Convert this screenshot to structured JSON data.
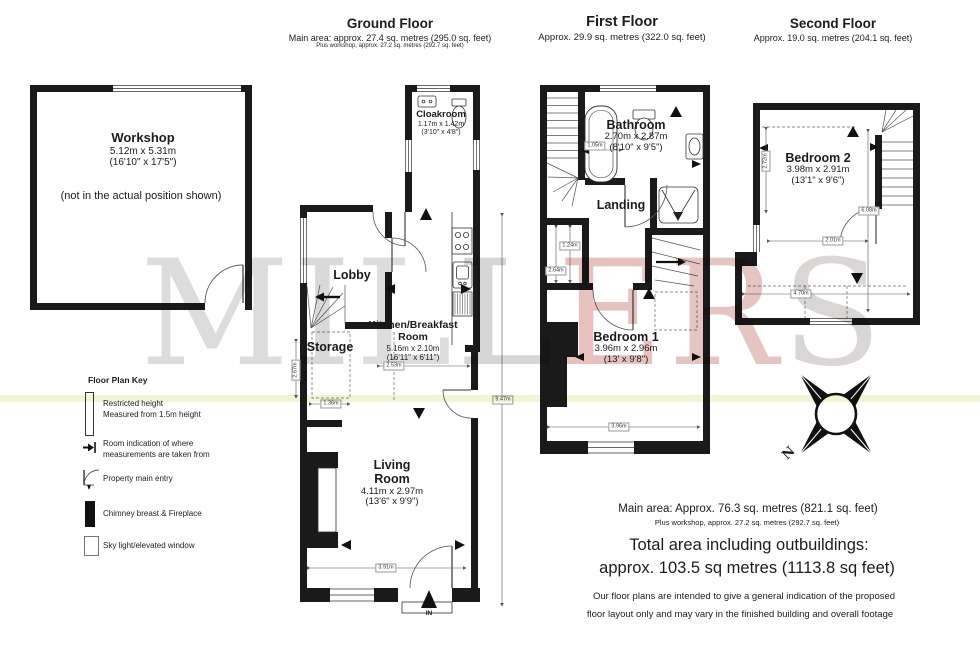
{
  "watermark": {
    "letters": [
      "M",
      "I",
      "L",
      "L",
      "E",
      "R",
      "S"
    ]
  },
  "floors": {
    "ground": {
      "title": "Ground Floor",
      "area_line1": "Main area: approx. 27.4 sq. metres (295.0 sq. feet)",
      "area_line2": "Plus workshop, approx. 27.2 sq. metres (292.7 sq. feet)",
      "workshop": {
        "name": "Workshop",
        "size_m": "5.12m x 5.31m",
        "size_ft": "(16'10\" x 17'5\")",
        "note": "(not in the actual position shown)"
      },
      "cloakroom": {
        "name": "Cloakroom",
        "size_m": "1.17m x 1.42m",
        "size_ft": "(3'10\" x 4'8\")"
      },
      "lobby": {
        "name": "Lobby"
      },
      "storage": {
        "name": "Storage"
      },
      "kitchen": {
        "name": "Kitchen/Breakfast Room",
        "size_m": "5.16m x 2.10m",
        "size_ft": "(16'11\" x 6'11\")"
      },
      "living": {
        "name": "Living Room",
        "size_m": "4.11m x 2.97m",
        "size_ft": "(13'6\" x 9'9\")"
      },
      "entry_label": "IN",
      "dims": {
        "left_height": "2.67m",
        "storage_width": "1.36m",
        "kitchen_width": "2.53m",
        "living_width": "3.91m",
        "total_height": "9.47m"
      }
    },
    "first": {
      "title": "First Floor",
      "area_line1": "Approx. 29.9 sq. metres (322.0 sq. feet)",
      "bathroom": {
        "name": "Bathroom",
        "size_m": "2.70m x 2.87m",
        "size_ft": "(8'10\" x 9'5\")"
      },
      "landing": {
        "name": "Landing"
      },
      "bedroom1": {
        "name": "Bedroom 1",
        "size_m": "3.96m x 2.96m",
        "size_ft": "(13' x 9'8\")"
      },
      "dims": {
        "bath_width": "1.05m",
        "closet_a": "1.24m",
        "closet_b": "2.64m",
        "bedroom_width": "3.96m"
      }
    },
    "second": {
      "title": "Second Floor",
      "area_line1": "Approx. 19.0 sq. metres (204.1 sq. feet)",
      "bedroom2": {
        "name": "Bedroom 2",
        "size_m": "3.98m x 2.91m",
        "size_ft": "(13'1\" x 9'6\")"
      },
      "dims": {
        "left_height": "2.72m",
        "mid_width": "2.01m",
        "bottom_width": "4.70m",
        "right_height": "6.08m"
      }
    }
  },
  "key": {
    "title": "Floor Plan Key",
    "items": [
      {
        "icon": "restricted-height-icon",
        "label": "Restricted height\nMeasured from 1.5m height"
      },
      {
        "icon": "measure-point-icon",
        "label": "Room indication of where\nmeasurements are taken from"
      },
      {
        "icon": "main-entry-icon",
        "label": "Property main entry"
      },
      {
        "icon": "chimney-icon",
        "label": "Chimney breast & Fireplace"
      },
      {
        "icon": "skylight-icon",
        "label": "Sky light/elevated window"
      }
    ]
  },
  "summary": {
    "main_area": "Main area: Approx. 76.3 sq. metres (821.1 sq. feet)",
    "workshop_area": "Plus workshop, approx. 27.2 sq. metres (292.7 sq. feet)",
    "total_line1": "Total area including  outbuildings:",
    "total_line2": "approx. 103.5 sq metres (1113.8 sq feet)",
    "disclaimer_line1": "Our floor plans are intended to give a general indication of the proposed",
    "disclaimer_line2": "floor layout only and may vary in the finished building and overall footage"
  },
  "compass": {
    "north": "N"
  },
  "colors": {
    "wall": "#1a1a1a",
    "watermark_gray": "#b9b9b9",
    "watermark_red": "#cf837d",
    "highlight": "#e6edab"
  }
}
